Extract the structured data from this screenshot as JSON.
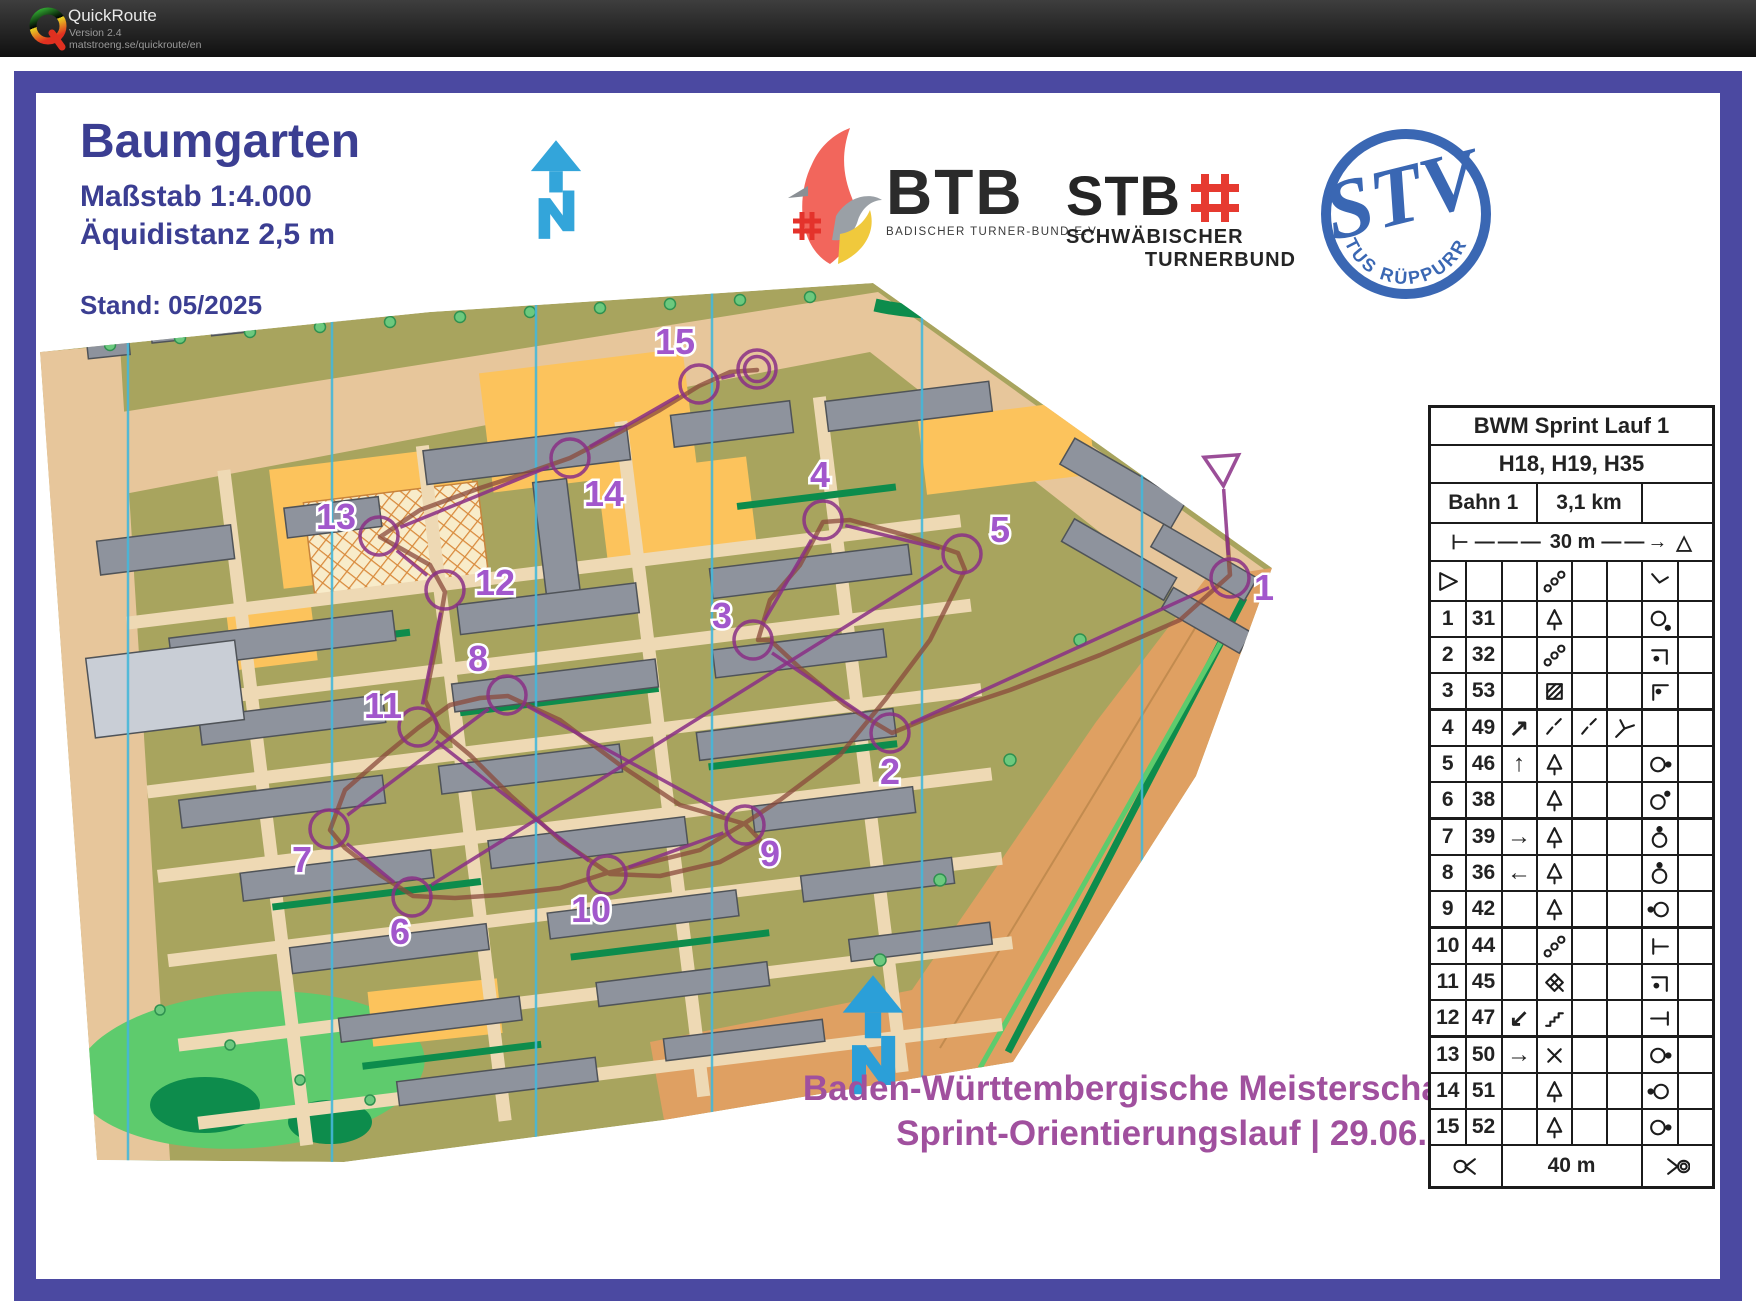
{
  "titlebar": {
    "app": "QuickRoute",
    "version": "Version 2.4",
    "url": "matstroeng.se/quickroute/en"
  },
  "map_header": {
    "title": "Baumgarten",
    "scale": "Maßstab 1:4.000",
    "equidistance": "Äquidistanz 2,5 m",
    "stand": "Stand: 05/2025"
  },
  "logos": {
    "btb": {
      "abbr": "BTB",
      "subtitle": "BADISCHER TURNER-BUND E.V."
    },
    "stb": {
      "abbr": "STB",
      "line1": "SCHWÄBISCHER",
      "line2": "TURNERBUND"
    },
    "tus": {
      "club": "TUS RÜPPURR",
      "monogram": "STV"
    }
  },
  "event": {
    "line1": "Baden-Württembergische Meisterschaften",
    "line2": "Sprint-Orientierungslauf | 29.06.2025"
  },
  "control_card": {
    "title": "BWM Sprint Lauf 1",
    "classes": "H18, H19, H35",
    "course_name": "Bahn 1",
    "course_length": "3,1 km",
    "extra": "",
    "start_distance": "30 m",
    "finish_distance": "40 m",
    "start_row": {
      "c1": "start-triangle",
      "c": "",
      "d": "chain",
      "e": "",
      "f": "",
      "g": "bent-line",
      "h": ""
    },
    "rows": [
      {
        "no": "1",
        "code": "31",
        "c": "",
        "d": "tree",
        "e": "",
        "f": "",
        "g": "circle-dot-se",
        "h": ""
      },
      {
        "no": "2",
        "code": "32",
        "c": "",
        "d": "chain",
        "e": "",
        "f": "",
        "g": "corner-dot-a",
        "h": ""
      },
      {
        "no": "3",
        "code": "53",
        "c": "",
        "d": "hatch-square",
        "e": "",
        "f": "",
        "g": "corner-dot-b",
        "h": ""
      },
      {
        "no": "4",
        "code": "49",
        "c": "arrow:↗",
        "d": "dash",
        "e": "dash",
        "f": "y-junction",
        "g": "",
        "h": ""
      },
      {
        "no": "5",
        "code": "46",
        "c": "arrow:↑",
        "d": "tree",
        "e": "",
        "f": "",
        "g": "circle-dot-e",
        "h": ""
      },
      {
        "no": "6",
        "code": "38",
        "c": "",
        "d": "tree",
        "e": "",
        "f": "",
        "g": "circle-dot-ne",
        "h": ""
      },
      {
        "no": "7",
        "code": "39",
        "c": "arrow:→",
        "d": "tree",
        "e": "",
        "f": "",
        "g": "circle-dot-n",
        "h": ""
      },
      {
        "no": "8",
        "code": "36",
        "c": "arrow:←",
        "d": "tree",
        "e": "",
        "f": "",
        "g": "circle-dot-n",
        "h": ""
      },
      {
        "no": "9",
        "code": "42",
        "c": "",
        "d": "tree",
        "e": "",
        "f": "",
        "g": "circle-dot-w",
        "h": ""
      },
      {
        "no": "10",
        "code": "44",
        "c": "",
        "d": "chain",
        "e": "",
        "f": "",
        "g": "t-left",
        "h": ""
      },
      {
        "no": "11",
        "code": "45",
        "c": "",
        "d": "thicket",
        "e": "",
        "f": "",
        "g": "corner-dot-a",
        "h": ""
      },
      {
        "no": "12",
        "code": "47",
        "c": "arrow:↙",
        "d": "stairs",
        "e": "",
        "f": "",
        "g": "t-right",
        "h": ""
      },
      {
        "no": "13",
        "code": "50",
        "c": "arrow:→",
        "d": "cross",
        "e": "",
        "f": "",
        "g": "circle-dot-e",
        "h": ""
      },
      {
        "no": "14",
        "code": "51",
        "c": "",
        "d": "tree",
        "e": "",
        "f": "",
        "g": "circle-dot-w",
        "h": ""
      },
      {
        "no": "15",
        "code": "52",
        "c": "",
        "d": "tree",
        "e": "",
        "f": "",
        "g": "circle-dot-e",
        "h": ""
      }
    ],
    "footer": {
      "left": "funnel-left",
      "label": "40 m",
      "right": "funnel-right"
    }
  },
  "course_overlay": {
    "circle_radius": 19,
    "colors": {
      "course": "#8a2f86",
      "gps_route": "#8a4a3c",
      "label": "#a257cc",
      "frame": "#4b49a1",
      "title_text": "#3b3e92",
      "event_text": "#a0509e",
      "north_arrow": "#33a5da"
    },
    "start": {
      "x": 1222,
      "y": 466
    },
    "finish": {
      "x": 757,
      "y": 369
    },
    "controls": [
      {
        "n": "1",
        "x": 1230,
        "y": 578,
        "lx": 1264,
        "ly": 600
      },
      {
        "n": "2",
        "x": 890,
        "y": 733,
        "lx": 890,
        "ly": 784
      },
      {
        "n": "3",
        "x": 753,
        "y": 640,
        "lx": 722,
        "ly": 628
      },
      {
        "n": "4",
        "x": 823,
        "y": 520,
        "lx": 820,
        "ly": 487
      },
      {
        "n": "5",
        "x": 962,
        "y": 554,
        "lx": 1000,
        "ly": 542
      },
      {
        "n": "6",
        "x": 412,
        "y": 897,
        "lx": 400,
        "ly": 944
      },
      {
        "n": "7",
        "x": 329,
        "y": 829,
        "lx": 302,
        "ly": 872
      },
      {
        "n": "8",
        "x": 507,
        "y": 695,
        "lx": 478,
        "ly": 671
      },
      {
        "n": "9",
        "x": 745,
        "y": 825,
        "lx": 770,
        "ly": 866
      },
      {
        "n": "10",
        "x": 607,
        "y": 875,
        "lx": 591,
        "ly": 922
      },
      {
        "n": "11",
        "x": 418,
        "y": 727,
        "lx": 383,
        "ly": 718
      },
      {
        "n": "12",
        "x": 445,
        "y": 590,
        "lx": 495,
        "ly": 595
      },
      {
        "n": "13",
        "x": 379,
        "y": 536,
        "lx": 336,
        "ly": 529
      },
      {
        "n": "14",
        "x": 570,
        "y": 458,
        "lx": 604,
        "ly": 506
      },
      {
        "n": "15",
        "x": 699,
        "y": 384,
        "lx": 675,
        "ly": 354
      }
    ]
  }
}
